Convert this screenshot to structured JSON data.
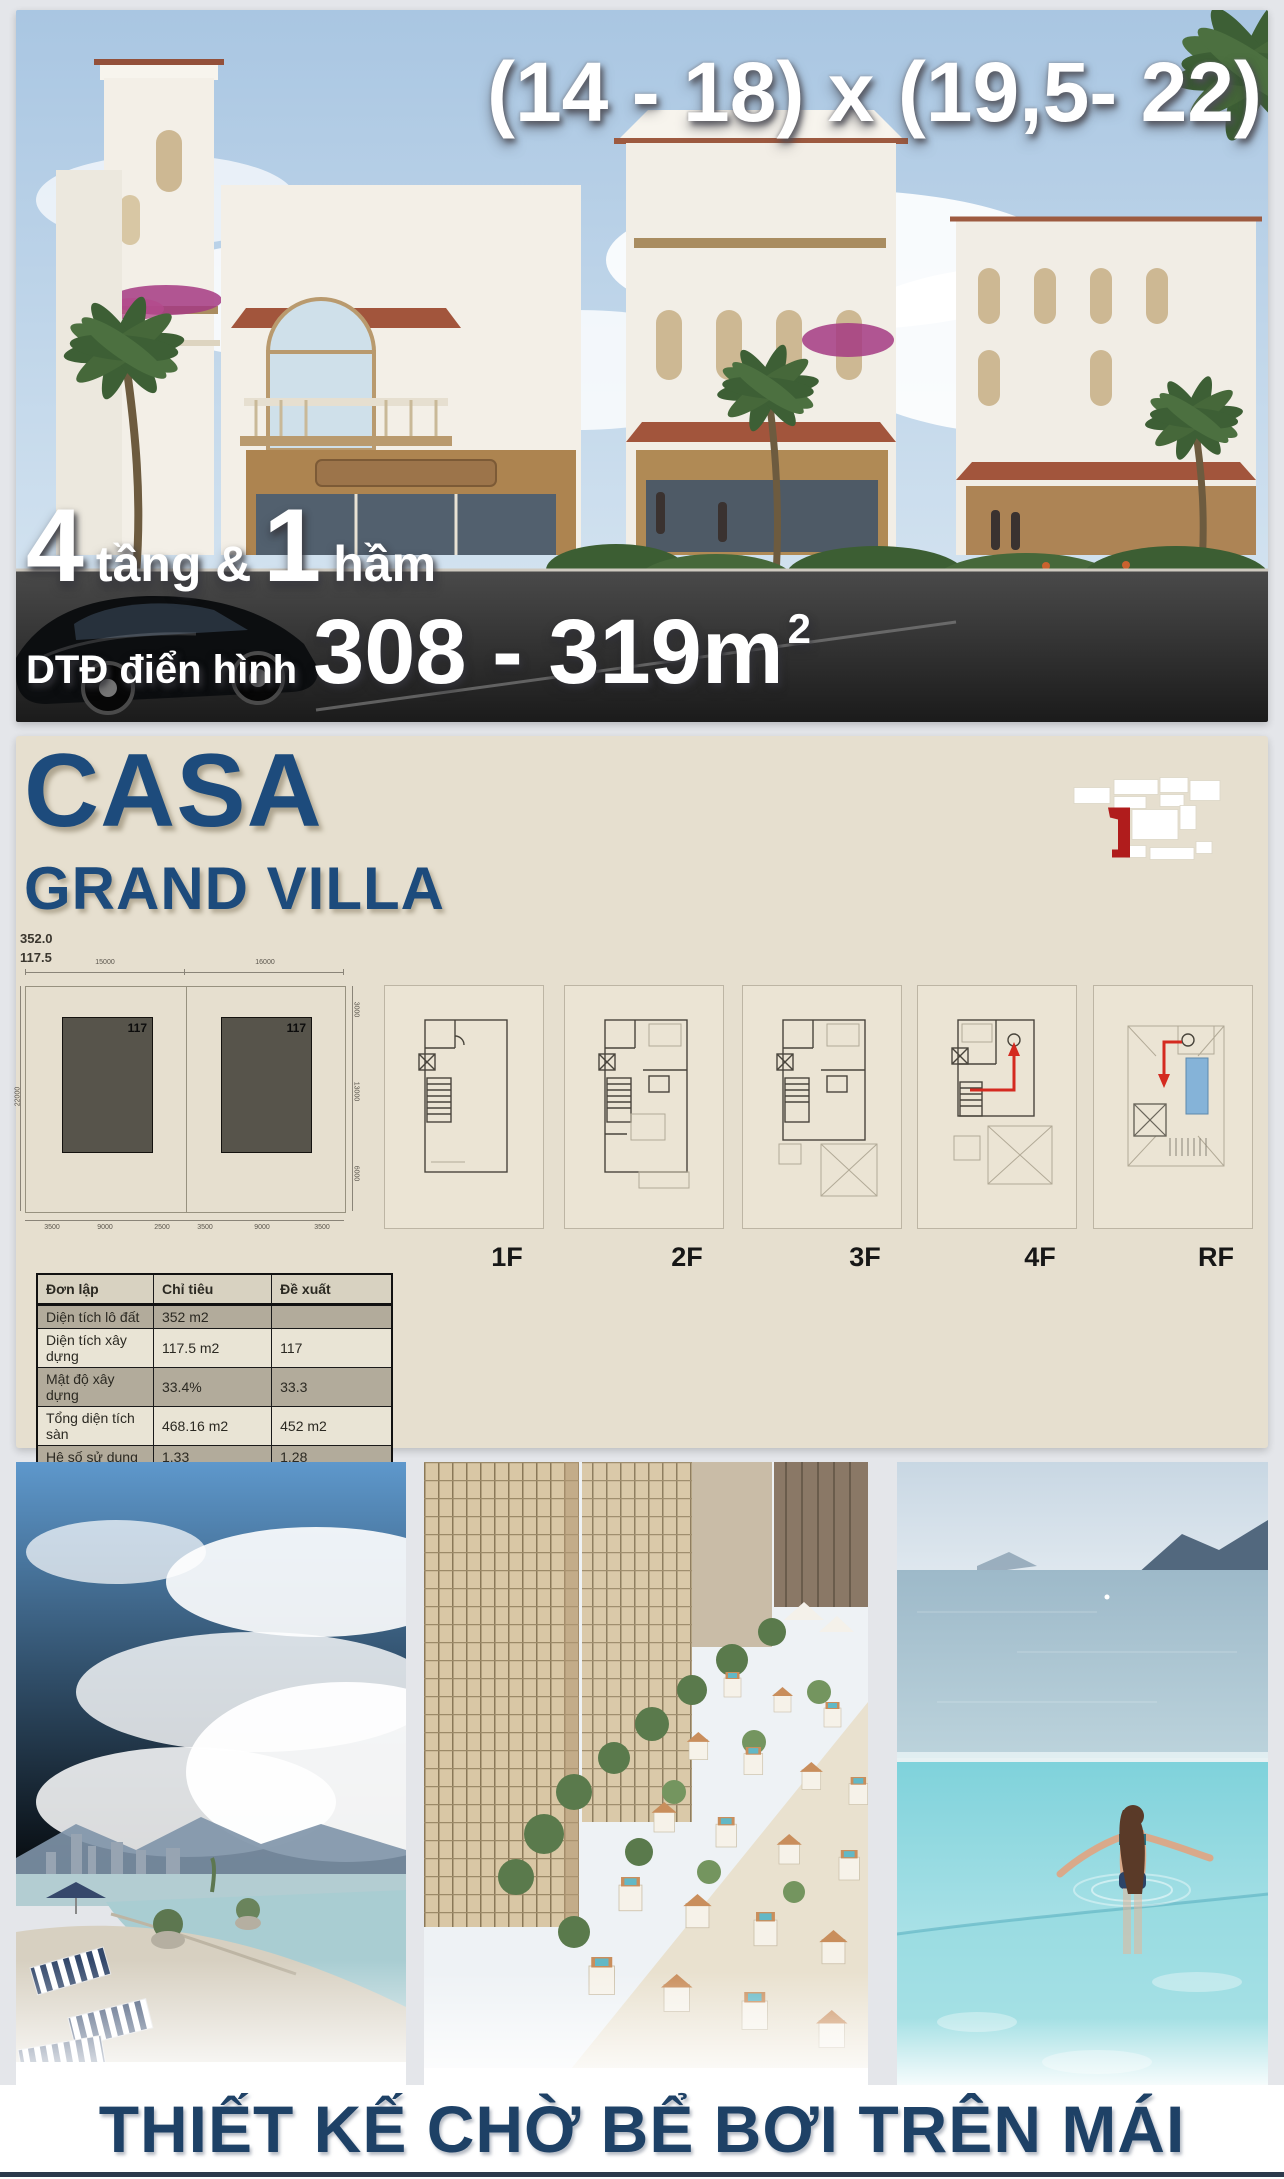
{
  "hero": {
    "size_text": "(14 - 18) x (19,5- 22)",
    "floors": {
      "big1": "4",
      "mid": "tầng &",
      "big2": "1",
      "end": "hầm"
    },
    "area": {
      "label": "DTĐ điển hình",
      "value": "308 - 319m",
      "sup": "2"
    }
  },
  "panel": {
    "title_line1": "CASA",
    "title_line2": "GRAND VILLA",
    "stat_area": "352.0",
    "stat_build": "117.5",
    "unit_label": "117",
    "dims": {
      "top": [
        "15000",
        "16000"
      ],
      "left": [
        "22000"
      ],
      "right": [
        "3000",
        "13000",
        "6000"
      ],
      "bottom": [
        "3500",
        "9000",
        "2500",
        "3500",
        "9000",
        "3500"
      ]
    },
    "floor_labels": [
      "1F",
      "2F",
      "3F",
      "4F",
      "RF"
    ],
    "table": {
      "headers": [
        "Đơn lập",
        "Chỉ tiêu",
        "Đề xuất"
      ],
      "rows": [
        [
          "Diện tích lô đất",
          "352 m2",
          ""
        ],
        [
          "Diện tích xây dựng",
          "117.5 m2",
          "117"
        ],
        [
          "Mật độ xây dựng",
          "33.4%",
          "33.3"
        ],
        [
          "Tổng diện tích sàn",
          "468.16 m2",
          "452 m2"
        ],
        [
          "Hệ số sử dụng",
          "1.33",
          "1.28"
        ]
      ]
    }
  },
  "footer": {
    "title": "THIẾT KẾ CHỜ BỂ BƠI TRÊN MÁI"
  },
  "colors": {
    "navy": "#1d4b7c",
    "footer_navy": "#1e4166",
    "red": "#b01c1c",
    "beige": "#e6dfcf",
    "pool_blue": "#85b3d8"
  }
}
